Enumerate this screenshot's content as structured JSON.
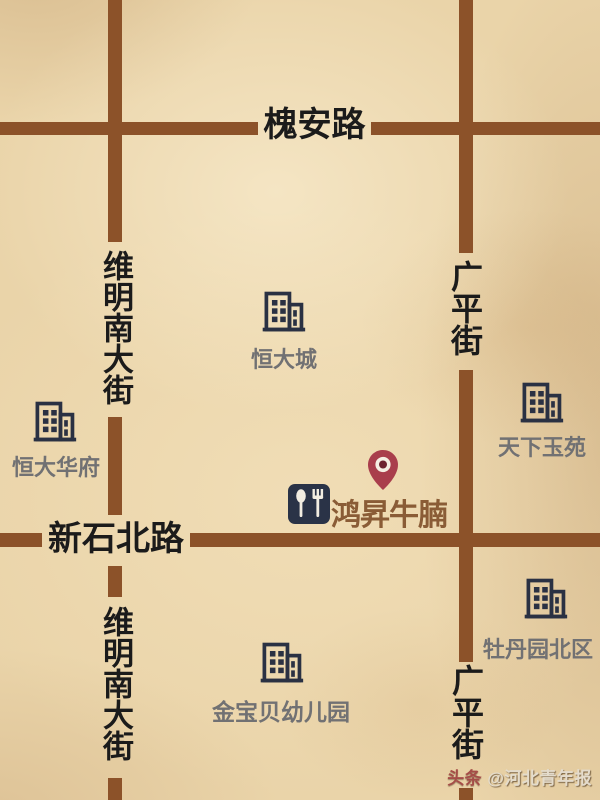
{
  "roads": {
    "huaian": {
      "label": "槐安路",
      "orientation": "horizontal"
    },
    "xinshibei": {
      "label": "新石北路",
      "orientation": "horizontal"
    },
    "weiming": {
      "label": "维明南大街",
      "orientation": "vertical"
    },
    "guangping": {
      "label": "广平街",
      "orientation": "vertical"
    }
  },
  "places": {
    "hengdacheng": {
      "label": "恒大城",
      "icon": "building-icon"
    },
    "hengdahuafu": {
      "label": "恒大华府",
      "icon": "building-icon"
    },
    "tianxiayuyuan": {
      "label": "天下玉苑",
      "icon": "building-icon"
    },
    "mudanyuan": {
      "label": "牡丹园北区",
      "icon": "building-icon"
    },
    "jinbaobei": {
      "label": "金宝贝幼儿园",
      "icon": "building-icon"
    }
  },
  "poi": {
    "label": "鸿昇牛腩",
    "marker": "map-pin-icon",
    "icon": "spoon-fork-icon"
  },
  "watermark": {
    "brand": "头条",
    "account": "@河北青年报"
  },
  "colors": {
    "paper": "#ead4a9",
    "road": "#8c5229",
    "road_label": "#1b1b1b",
    "building_icon": "#2a3143",
    "place_label": "#717173",
    "poi_text": "#8a5c36",
    "poi_icon_bg": "#2a3347",
    "pin_body": "#a93e4c",
    "pin_ring": "#f5efe3",
    "pin_center": "#6e2430"
  }
}
